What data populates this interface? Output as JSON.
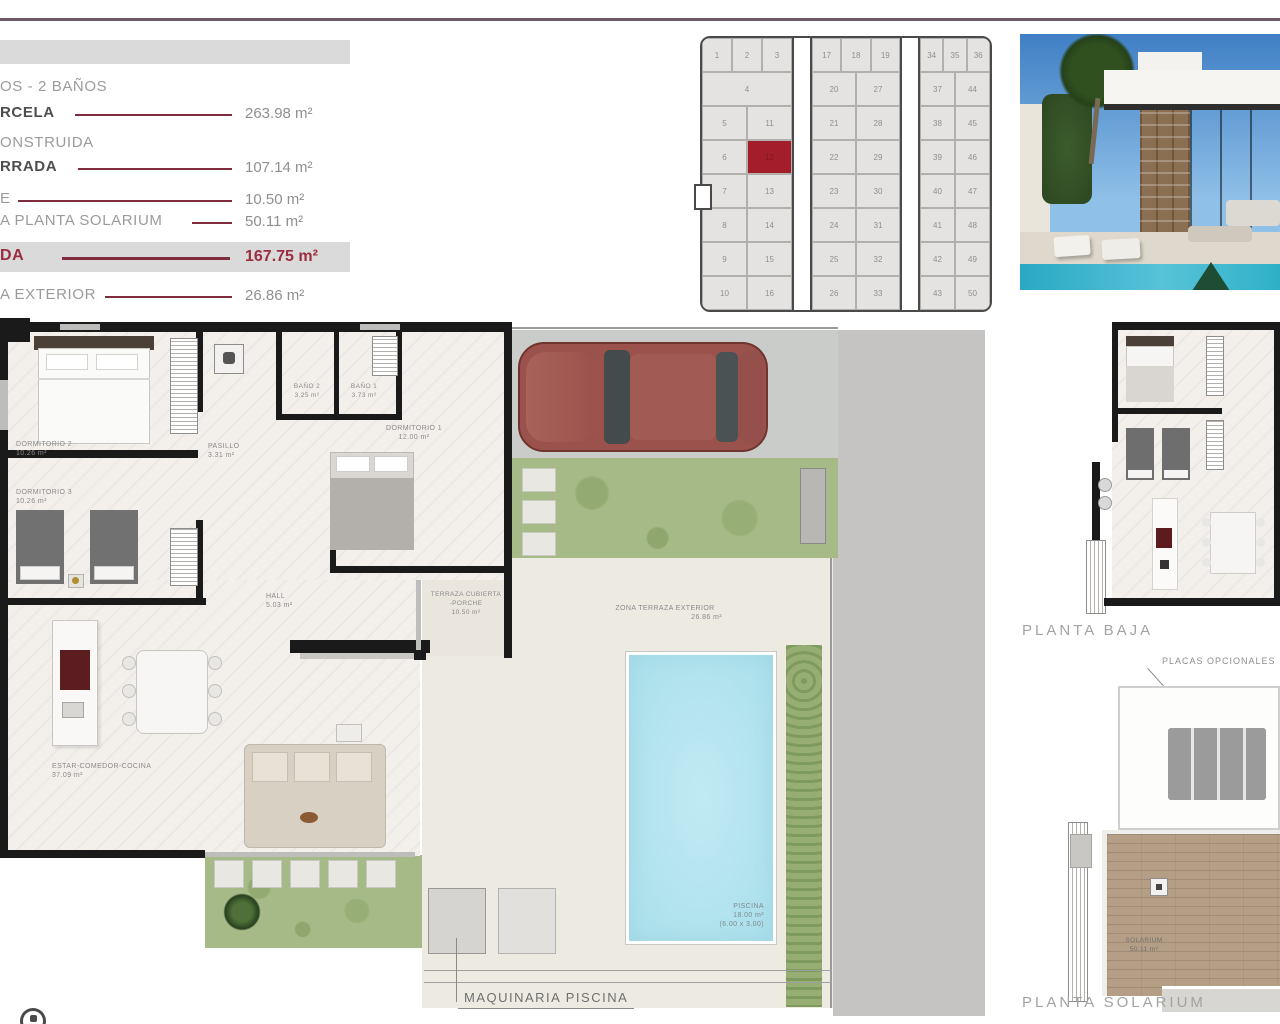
{
  "accents": {
    "maroon": "#8e2f42",
    "highlight_red": "#a41d2a",
    "top_rule": "#6d5a66"
  },
  "info_panel": {
    "header_fragment": "OS - 2 BAÑOS",
    "items": [
      {
        "label": "RCELA",
        "value": "263.98 m²"
      },
      {
        "label": "ONSTRUIDA",
        "value": ""
      },
      {
        "label": "RRADA",
        "value": "107.14 m²"
      },
      {
        "label": "E",
        "value": "10.50 m²"
      },
      {
        "label": "A PLANTA SOLARIUM",
        "value": "50.11 m²"
      },
      {
        "label": "DA",
        "value": "167.75 m²"
      },
      {
        "label": "A EXTERIOR",
        "value": "26.86 m²"
      }
    ]
  },
  "site_plan": {
    "highlighted_lot": "12",
    "groups": [
      {
        "top_row": [
          "1",
          "2",
          "3"
        ],
        "rows": [
          [
            "4"
          ],
          [
            "5",
            "11"
          ],
          [
            "6",
            "12"
          ],
          [
            "7",
            "13"
          ],
          [
            "8",
            "14"
          ],
          [
            "9",
            "15"
          ],
          [
            "10",
            "16"
          ]
        ]
      },
      {
        "top_row": [
          "17",
          "18",
          "19"
        ],
        "rows": [
          [
            "20",
            "27"
          ],
          [
            "21",
            "28"
          ],
          [
            "22",
            "29"
          ],
          [
            "23",
            "30"
          ],
          [
            "24",
            "31"
          ],
          [
            "25",
            "32"
          ],
          [
            "26",
            "33"
          ]
        ]
      },
      {
        "top_row": [
          "34",
          "35",
          "36"
        ],
        "rows": [
          [
            "37",
            "44"
          ],
          [
            "38",
            "45"
          ],
          [
            "39",
            "46"
          ],
          [
            "40",
            "47"
          ],
          [
            "41",
            "48"
          ],
          [
            "42",
            "49"
          ],
          [
            "43",
            "50"
          ]
        ]
      }
    ]
  },
  "floor_plan": {
    "rooms": [
      {
        "name": "DORMITORIO 2",
        "area": "10.26 m²"
      },
      {
        "name": "DORMITORIO 3",
        "area": "10.26 m²"
      },
      {
        "name": "PASILLO",
        "area": "3.31 m²"
      },
      {
        "name": "BAÑO 2",
        "area": "3.25 m²"
      },
      {
        "name": "BAÑO 1",
        "area": "3.73 m²"
      },
      {
        "name": "DORMITORIO 1",
        "area": "12.00 m²"
      },
      {
        "name": "HALL",
        "area": "5.03 m²"
      },
      {
        "name": "TERRAZA CUBIERTA",
        "name2": "-PORCHE",
        "area": "10.50 m²"
      },
      {
        "name": "ZONA TERRAZA EXTERIOR",
        "area": "26.86 m²"
      },
      {
        "name": "ESTAR-COMEDOR-COCINA",
        "area": "37.09 m²"
      },
      {
        "name": "PISCINA",
        "area": "18.00 m²",
        "dims": "(6.00 x 3.00)"
      },
      {
        "name": "SOLARIUM",
        "area": "50.11 m²"
      }
    ],
    "maquinaria_label": "MAQUINARIA PISCINA"
  },
  "mini_plans": {
    "planta_baja_label": "PLANTA BAJA",
    "placas_label": "PLACAS OPCIONALES",
    "solarium_label": "PLANTA SOLARIUM"
  }
}
